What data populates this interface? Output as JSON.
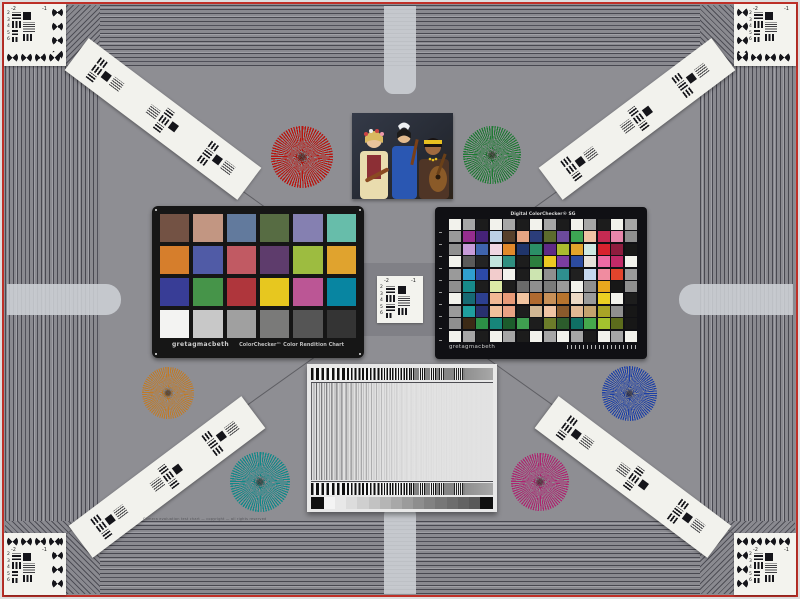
{
  "meta": {
    "description": "Photographed multi-target camera evaluation test chart"
  },
  "labels": {
    "neg2": "-2",
    "neg1": "-1"
  },
  "corner": {
    "numbers": [
      "2",
      "3",
      "4",
      "5",
      "6"
    ]
  },
  "fine_print": "Camera evaluation test chart — copyright — all rights reserved",
  "colorchecker24": {
    "brand": "gretagmacbeth",
    "title": "ColorChecker™ Color Rendition Chart",
    "rows": [
      [
        "#735244",
        "#c29682",
        "#627a9d",
        "#576c43",
        "#8580b1",
        "#67bdaa"
      ],
      [
        "#d67e2c",
        "#505ba6",
        "#c15a63",
        "#5e3c6c",
        "#9dbc40",
        "#e0a32e"
      ],
      [
        "#383d96",
        "#469449",
        "#af363c",
        "#e7c71f",
        "#bb5695",
        "#0885a1"
      ],
      [
        "#f3f3f2",
        "#c8c8c8",
        "#a0a0a0",
        "#7a7a79",
        "#555555",
        "#343434"
      ]
    ]
  },
  "colorchecker_sg": {
    "title": "Digital ColorChecker® SG",
    "brand": "gretagmacbeth",
    "rows": [
      [
        "#f2f2ec",
        "#a6a6a6",
        "#1c1c1c",
        "#f2f2ec",
        "#a6a6a6",
        "#1c1c1c",
        "#f2f2ec",
        "#a6a6a6",
        "#1c1c1c",
        "#f2f2ec",
        "#a6a6a6",
        "#1c1c1c",
        "#f2f2ec",
        "#a6a6a6"
      ],
      [
        "#9a9a9a",
        "#962d8e",
        "#452277",
        "#bcd0e6",
        "#57402b",
        "#e6a583",
        "#2b3d7a",
        "#5c6b2d",
        "#6c4a9c",
        "#3da553",
        "#efc4a4",
        "#c42a52",
        "#e886ab",
        "#8f8f8f"
      ],
      [
        "#8f8f8f",
        "#c79bd9",
        "#3f64ad",
        "#f0d6e2",
        "#e2892b",
        "#20356b",
        "#2b8f66",
        "#5e2a86",
        "#aabb2e",
        "#e2a52b",
        "#cfeae2",
        "#d8222e",
        "#8e1c3e",
        "#171717"
      ],
      [
        "#f2f2ec",
        "#5a5a5a",
        "#232323",
        "#c2e4de",
        "#2f8f80",
        "#1d1d1d",
        "#2c7e3e",
        "#ecc922",
        "#7b3da0",
        "#2c4ba0",
        "#e8e2da",
        "#ec6ba4",
        "#c22a68",
        "#f2f2ec"
      ],
      [
        "#9a9a9a",
        "#2f9fd0",
        "#2c4aa8",
        "#f2cccc",
        "#f2f2ec",
        "#1d1d1d",
        "#cce4b0",
        "#8f8f8f",
        "#2f8f8f",
        "#202020",
        "#c6d8f0",
        "#f08ca0",
        "#e2442c",
        "#9a9a9a"
      ],
      [
        "#8f8f8f",
        "#178a8a",
        "#1d1d1d",
        "#dceaa6",
        "#1d1d1d",
        "#6a6a6a",
        "#8f8f8f",
        "#7a7a7a",
        "#9a9a9a",
        "#f2f2ec",
        "#8f8f8f",
        "#e8a81e",
        "#171717",
        "#8f8f8f"
      ],
      [
        "#f2f2ec",
        "#176a74",
        "#2c3f90",
        "#f2b894",
        "#e89a78",
        "#f2c4a0",
        "#b06a30",
        "#c89058",
        "#b8742e",
        "#ecd8c4",
        "#9a9a9a",
        "#ecd022",
        "#f2f2ec",
        "#1d1d1d"
      ],
      [
        "#9a9a9a",
        "#1f9e9e",
        "#28306e",
        "#f2c09c",
        "#eaa284",
        "#1d1d1d",
        "#d0b694",
        "#f0c4a4",
        "#8a5a2c",
        "#e0b894",
        "#c4a26e",
        "#a8a426",
        "#8f8f8f",
        "#171717"
      ],
      [
        "#8f8f8f",
        "#3c2a16",
        "#2c8f46",
        "#17867a",
        "#1c5c2c",
        "#3f9e50",
        "#1d1d1d",
        "#6c7c2a",
        "#2c5c2c",
        "#0f6f64",
        "#46a84c",
        "#a2c22e",
        "#5c6c1c",
        "#171717"
      ],
      [
        "#f2f2ec",
        "#a6a6a6",
        "#1c1c1c",
        "#f2f2ec",
        "#a6a6a6",
        "#1c1c1c",
        "#f2f2ec",
        "#a6a6a6",
        "#f2f2ec",
        "#a6a6a6",
        "#1c1c1c",
        "#f2f2ec",
        "#a6a6a6",
        "#f2f2ec"
      ]
    ]
  },
  "stars": {
    "red": {
      "color": "#b8150f"
    },
    "green": {
      "color": "#1e7a33"
    },
    "orange": {
      "color": "#c07b28"
    },
    "blue": {
      "color": "#1c3fa6"
    },
    "teal": {
      "color": "#128888"
    },
    "magenta": {
      "color": "#ad2470"
    }
  },
  "sweep": {
    "wedge_end": "#101010",
    "wedge_steps": [
      "#f4f4f4",
      "#e8e8e8",
      "#dcdcdc",
      "#cfcfcf",
      "#c2c2c2",
      "#b5b5b5",
      "#a8a8a8",
      "#9b9b9b",
      "#8e8e8e",
      "#828282",
      "#777777",
      "#6d6d6d",
      "#636363",
      "#595959"
    ]
  },
  "photo": {
    "alt": "Three women musicians with folk instruments"
  }
}
